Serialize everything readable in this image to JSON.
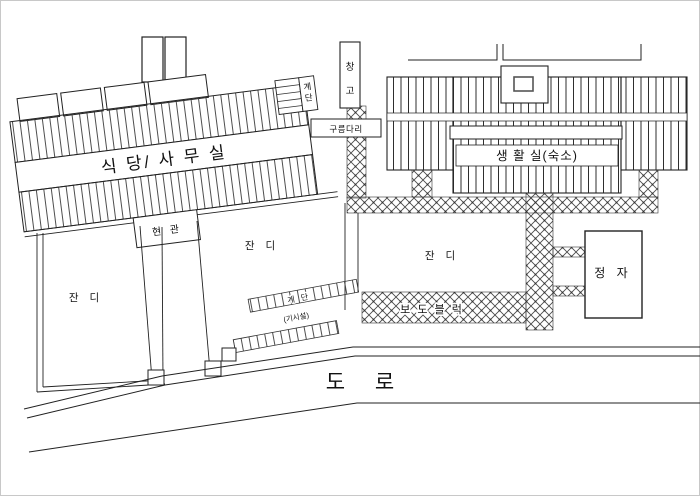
{
  "drawing": {
    "type": "architectural-site-plan",
    "labels": {
      "dining_office": "식 당/ 사 무 실",
      "entrance": "현 관",
      "roof_stairs_top": "계",
      "roof_stairs_bottom": "단",
      "warehouse_top": "창",
      "warehouse_bottom": "고",
      "bridge": "구름다리",
      "dormitory": "생 활 실(숙소)",
      "pavement": "보 도 블 럭",
      "pavilion": "정  자",
      "lawn_left": "잔 디",
      "lawn_middle": "잔 디",
      "lawn_court": "잔 디",
      "stairs": "계 단",
      "stairs_note": "(기시설)",
      "road": "도  로"
    },
    "colors": {
      "line": "#222222",
      "hatch": "#3a3a3a",
      "background": "#ffffff",
      "border": "#c8c8c8"
    }
  }
}
